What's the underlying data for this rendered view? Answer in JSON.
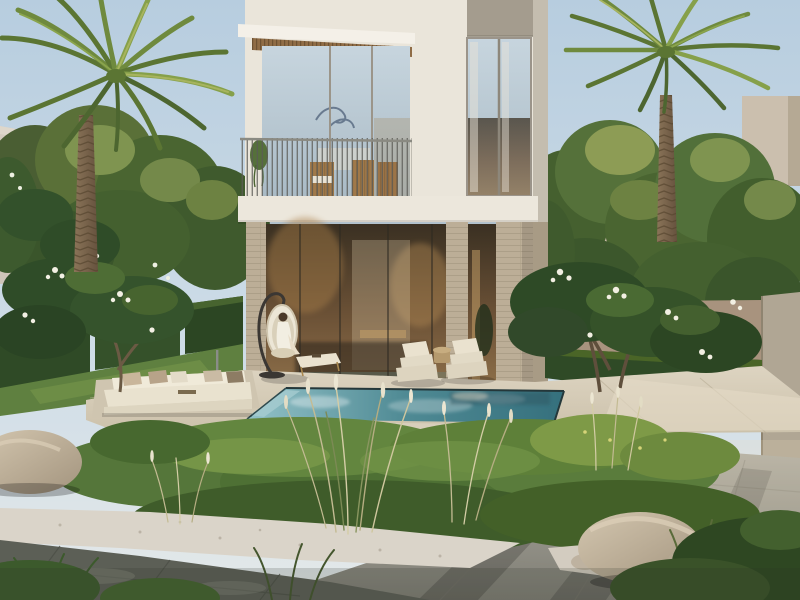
{
  "scene": {
    "alt": "Architectural rendering of a modern two-storey villa with floor-to-ceiling glazing, balcony with slim railing, travertine stone columns, turquoise swimming pool, two sun loungers, hanging egg chair with seated woman, sunken white sofa, palm trees, frangipani trees with white flowers, wild grasses, boulders, white gravel and stone paving"
  },
  "palette": {
    "sky_top": "#b7cddf",
    "sky_mid": "#cfdde7",
    "sky_low": "#e4e9e9",
    "villa_wall": "#eae5da",
    "villa_fascia": "#f4f0e8",
    "taupe_panel": "#a49c8e",
    "wood_soffit": "#8f6c46",
    "slab": "#ece7dc",
    "glass_sky_top": "#c7d5de",
    "glass_sky_bottom": "#aabbc6",
    "glass_warm_top": "#3a3022",
    "glass_warm_mid": "#6b5136",
    "glass_warm_low": "#8d6f49",
    "travertine": "#bcae97",
    "pool_light": "#93c2c8",
    "pool_mid": "#4f8a94",
    "pool_deep": "#35707d",
    "deck_light": "#ddd4c1",
    "deck_dark": "#c8bda6",
    "lawn": "#5f8040",
    "hedge_dark": "#2f4a26",
    "tree_dark": "#33512b",
    "tree_mid": "#4e6d35",
    "tree_light": "#7f9450",
    "tree_olive": "#8d9c55",
    "palm_green": "#6f8a3e",
    "palm_dark": "#4d6630",
    "palm_light": "#8aa44c",
    "palm_trunk_light": "#8a7458",
    "palm_trunk_dark": "#66523e",
    "frangipani_leaf": "#2f4c28",
    "flower_white": "#f3f0e4",
    "neighbor_wall": "#d4ccc0",
    "neighbor_box": "#c9bcaa",
    "boundary_wall": "#a8937e",
    "wall_pillar": "#b0a694",
    "gravel": "#dad4c9",
    "paving_light": "#a6a39a",
    "paving_shadow": "#5c5f56",
    "rock_light": "#d3c6af",
    "rock_dark": "#a3947e",
    "sofa_white": "#f0ead9",
    "cushion_tan": "#c9b69b",
    "chair_cream": "#eae2cf",
    "stand_dark": "#3b3733",
    "grass_plume": "#e8e2cd",
    "grass_blade": "#c3bb93"
  }
}
